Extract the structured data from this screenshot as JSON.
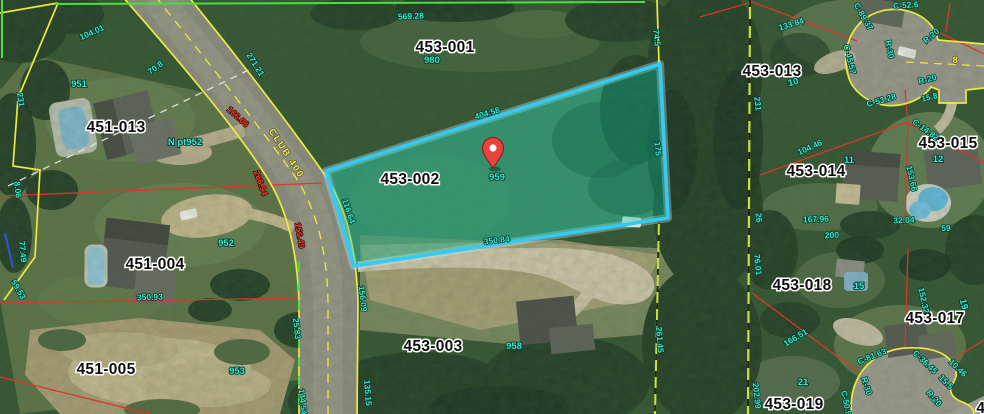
{
  "map": {
    "title": "Parcel map aerial view",
    "road_name_label": "CLUB 400",
    "centerline_number": "8",
    "highlighted_parcel": {
      "id": "453-002",
      "address": "959",
      "dimensions": {
        "top": "404.58",
        "left": "116.64",
        "bottom": "350.84",
        "right": "175"
      }
    },
    "parcels": [
      {
        "id": "453-001",
        "address": "980"
      },
      {
        "id": "453-002",
        "address": "959",
        "highlighted": true
      },
      {
        "id": "453-003",
        "address": "958"
      },
      {
        "id": "451-013",
        "address": "951"
      },
      {
        "id": "451-004",
        "address": "952"
      },
      {
        "id": "451-005",
        "address": "953"
      },
      {
        "id": "453-013",
        "address": "10"
      },
      {
        "id": "453-014",
        "address": "11"
      },
      {
        "id": "453-015",
        "address": "12"
      },
      {
        "id": "453-017",
        "address": "19"
      },
      {
        "id": "453-018",
        "address": "15"
      },
      {
        "id": "453-019",
        "address": "21"
      }
    ]
  },
  "colors": {
    "line-yellow": "#ece93f",
    "line-green": "#47e03c",
    "line-red": "#d9372a",
    "line-white": "#e8ece4",
    "line-blue": "#2e55cc",
    "highlight-stroke": "#38c9f2",
    "highlight-fill": "#00c9a7",
    "label-teal": "#3ae8ca",
    "label-red": "#ef3b2d",
    "label-road": "#efe96e",
    "pin-red": "#e8433c"
  },
  "labels": [
    {
      "cls": "parcel",
      "text": "453-001",
      "x": 445,
      "y": 52,
      "rot": 0
    },
    {
      "cls": "parcel",
      "text": "453-002",
      "x": 410,
      "y": 184,
      "rot": 0
    },
    {
      "cls": "parcel",
      "text": "451-013",
      "x": 116,
      "y": 132,
      "rot": 0
    },
    {
      "cls": "parcel",
      "text": "451-004",
      "x": 155,
      "y": 269,
      "rot": 0
    },
    {
      "cls": "parcel",
      "text": "451-005",
      "x": 106,
      "y": 374,
      "rot": 0
    },
    {
      "cls": "parcel",
      "text": "453-003",
      "x": 433,
      "y": 351,
      "rot": 0
    },
    {
      "cls": "parcel",
      "text": "453-013",
      "x": 772,
      "y": 76,
      "rot": 0
    },
    {
      "cls": "parcel",
      "text": "453-015",
      "x": 948,
      "y": 148,
      "rot": 0
    },
    {
      "cls": "parcel",
      "text": "453-014",
      "x": 816,
      "y": 176,
      "rot": 0
    },
    {
      "cls": "parcel",
      "text": "453-018",
      "x": 802,
      "y": 290,
      "rot": 0
    },
    {
      "cls": "parcel",
      "text": "453-017",
      "x": 935,
      "y": 323,
      "rot": 0
    },
    {
      "cls": "parcel",
      "text": "453-019",
      "x": 794,
      "y": 409,
      "rot": 0
    },
    {
      "cls": "parcel",
      "text": "453-0",
      "x": 997,
      "y": 413,
      "rot": 0
    },
    {
      "cls": "addr",
      "text": "980",
      "x": 432,
      "y": 63,
      "rot": 0
    },
    {
      "cls": "addr",
      "text": "951",
      "x": 79,
      "y": 87,
      "rot": 0
    },
    {
      "cls": "addr",
      "text": "N pt952",
      "x": 185,
      "y": 145,
      "rot": 0
    },
    {
      "cls": "addr",
      "text": "952",
      "x": 226,
      "y": 246,
      "rot": 0
    },
    {
      "cls": "addr",
      "text": "953",
      "x": 237,
      "y": 374,
      "rot": 0
    },
    {
      "cls": "addr",
      "text": "958",
      "x": 514,
      "y": 349,
      "rot": 0
    },
    {
      "cls": "addr",
      "text": "959",
      "x": 497,
      "y": 180,
      "rot": 0
    },
    {
      "cls": "addr",
      "text": "10",
      "x": 794,
      "y": 85,
      "rot": -15
    },
    {
      "cls": "addr",
      "text": "11",
      "x": 849,
      "y": 163,
      "rot": 0
    },
    {
      "cls": "addr",
      "text": "12",
      "x": 938,
      "y": 162,
      "rot": 0
    },
    {
      "cls": "addr",
      "text": "15",
      "x": 859,
      "y": 289,
      "rot": 0
    },
    {
      "cls": "addr",
      "text": "19",
      "x": 961,
      "y": 305,
      "rot": 75
    },
    {
      "cls": "addr",
      "text": "21",
      "x": 803,
      "y": 385,
      "rot": 0
    },
    {
      "cls": "dim",
      "text": "569.28",
      "x": 411,
      "y": 19,
      "rot": -3
    },
    {
      "cls": "dim",
      "text": "104.01",
      "x": 93,
      "y": 35,
      "rot": -24
    },
    {
      "cls": "dim",
      "text": "70.8",
      "x": 157,
      "y": 70,
      "rot": -36
    },
    {
      "cls": "dim",
      "text": "271.21",
      "x": 253,
      "y": 66,
      "rot": 58
    },
    {
      "cls": "dim",
      "text": "231",
      "x": 18,
      "y": 100,
      "rot": 82
    },
    {
      "cls": "dim",
      "text": "8.06",
      "x": 15,
      "y": 190,
      "rot": 84
    },
    {
      "cls": "dim",
      "text": "77.49",
      "x": 20,
      "y": 252,
      "rot": 84
    },
    {
      "cls": "dim",
      "text": "59.53",
      "x": 16,
      "y": 291,
      "rot": 60
    },
    {
      "cls": "dim",
      "text": "350.93",
      "x": 150,
      "y": 300,
      "rot": -2
    },
    {
      "cls": "dim",
      "text": "25.83",
      "x": 294,
      "y": 329,
      "rot": 84
    },
    {
      "cls": "dim",
      "text": "144.54",
      "x": 300,
      "y": 402,
      "rot": 84
    },
    {
      "cls": "dim",
      "text": "116.64",
      "x": 346,
      "y": 212,
      "rot": 72
    },
    {
      "cls": "dim",
      "text": "404.58",
      "x": 488,
      "y": 116,
      "rot": -17
    },
    {
      "cls": "dim",
      "text": "350.84",
      "x": 497,
      "y": 243,
      "rot": -7
    },
    {
      "cls": "dim",
      "text": "175",
      "x": 655,
      "y": 149,
      "rot": 84
    },
    {
      "cls": "dim",
      "text": "74.5",
      "x": 654,
      "y": 38,
      "rot": 84
    },
    {
      "cls": "dim",
      "text": "135.15",
      "x": 365,
      "y": 393,
      "rot": 86
    },
    {
      "cls": "dim",
      "text": "156.09",
      "x": 360,
      "y": 299,
      "rot": 84
    },
    {
      "cls": "dim",
      "text": "261.45",
      "x": 657,
      "y": 340,
      "rot": 86
    },
    {
      "cls": "dim",
      "text": "133.84",
      "x": 792,
      "y": 27,
      "rot": -17
    },
    {
      "cls": "dim",
      "text": "C-52.6",
      "x": 906,
      "y": 8,
      "rot": -4
    },
    {
      "cls": "dim",
      "text": "C-89.37",
      "x": 861,
      "y": 18,
      "rot": 60
    },
    {
      "cls": "dim",
      "text": "R-20",
      "x": 933,
      "y": 38,
      "rot": -40
    },
    {
      "cls": "dim",
      "text": "R-20",
      "x": 928,
      "y": 82,
      "rot": -14
    },
    {
      "cls": "dim",
      "text": "R-30",
      "x": 887,
      "y": 50,
      "rot": 78
    },
    {
      "cls": "dim",
      "text": "C-45.57",
      "x": 847,
      "y": 60,
      "rot": 76
    },
    {
      "cls": "dim",
      "text": "C-53.28",
      "x": 882,
      "y": 103,
      "rot": -16
    },
    {
      "cls": "dim",
      "text": "15.8",
      "x": 930,
      "y": 100,
      "rot": -12
    },
    {
      "cls": "dim",
      "text": "231",
      "x": 755,
      "y": 104,
      "rot": 84
    },
    {
      "cls": "dim",
      "text": "104.46",
      "x": 811,
      "y": 150,
      "rot": -24
    },
    {
      "cls": "dim",
      "text": "153.66",
      "x": 909,
      "y": 179,
      "rot": 78
    },
    {
      "cls": "dim",
      "text": "C-14.82",
      "x": 924,
      "y": 132,
      "rot": 36
    },
    {
      "cls": "dim",
      "text": "167.96",
      "x": 816,
      "y": 222,
      "rot": -2
    },
    {
      "cls": "dim",
      "text": "200",
      "x": 832,
      "y": 238,
      "rot": -2
    },
    {
      "cls": "dim",
      "text": "32.04",
      "x": 904,
      "y": 223,
      "rot": -2
    },
    {
      "cls": "dim",
      "text": "59",
      "x": 946,
      "y": 231,
      "rot": -2
    },
    {
      "cls": "dim",
      "text": "26",
      "x": 756,
      "y": 218,
      "rot": 84
    },
    {
      "cls": "dim",
      "text": "76.01",
      "x": 755,
      "y": 265,
      "rot": 84
    },
    {
      "cls": "dim",
      "text": "202.99",
      "x": 754,
      "y": 396,
      "rot": 84
    },
    {
      "cls": "dim",
      "text": "152.32",
      "x": 921,
      "y": 301,
      "rot": 78
    },
    {
      "cls": "dim",
      "text": "166.51",
      "x": 797,
      "y": 340,
      "rot": -31
    },
    {
      "cls": "dim",
      "text": "C-81.63",
      "x": 873,
      "y": 359,
      "rot": -22
    },
    {
      "cls": "dim",
      "text": "C-36.45",
      "x": 923,
      "y": 364,
      "rot": 44
    },
    {
      "cls": "dim",
      "text": "10.46",
      "x": 956,
      "y": 370,
      "rot": 44
    },
    {
      "cls": "dim",
      "text": "15.5",
      "x": 944,
      "y": 384,
      "rot": 46
    },
    {
      "cls": "dim",
      "text": "R-20",
      "x": 932,
      "y": 400,
      "rot": 48
    },
    {
      "cls": "dim",
      "text": "R-30",
      "x": 864,
      "y": 387,
      "rot": 72
    },
    {
      "cls": "dim",
      "text": "C-50.99",
      "x": 844,
      "y": 406,
      "rot": 78
    },
    {
      "cls": "dim",
      "text": "11",
      "x": 986,
      "y": 390,
      "rot": 45
    },
    {
      "cls": "red",
      "text": "266.94",
      "x": 258,
      "y": 184,
      "rot": 70
    },
    {
      "cls": "red",
      "text": "156.49",
      "x": 297,
      "y": 236,
      "rot": 80
    },
    {
      "cls": "red",
      "text": "166.06",
      "x": 236,
      "y": 119,
      "rot": 42
    },
    {
      "cls": "road",
      "text": "CLUB 400",
      "x": 284,
      "y": 155,
      "rot": 57
    },
    {
      "cls": "road",
      "text": "8",
      "x": 956,
      "y": 63,
      "rot": 0
    }
  ]
}
